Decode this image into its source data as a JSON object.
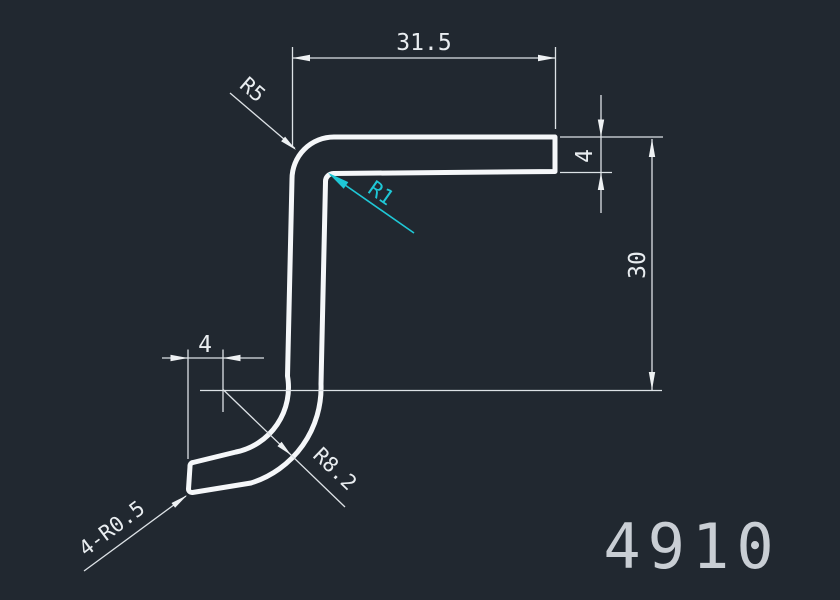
{
  "drawing": {
    "number": "4910",
    "background_color": "#212830",
    "line_color": "#dde2e6",
    "profile_color": "#f5f7f9",
    "accent_color": "#1fc8d6",
    "number_color": "#c9ced4",
    "dimensions": {
      "top_width": "31.5",
      "flange_thickness": "4",
      "height": "30",
      "bottom_flat": "4",
      "outer_bend_radius": "R5",
      "inner_bend_radius": "R1",
      "bottom_bend_radius": "R8.2",
      "end_corner_radius": "4-R0.5"
    }
  }
}
